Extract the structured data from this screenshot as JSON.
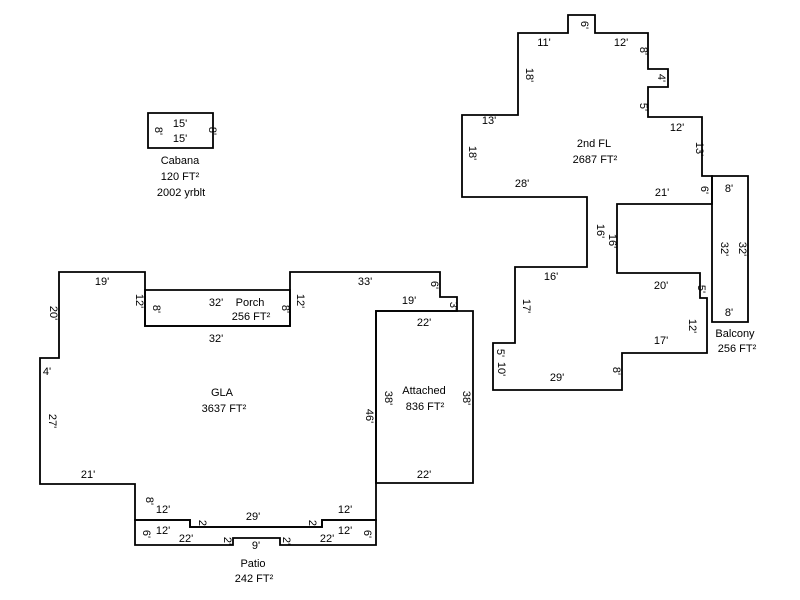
{
  "sketch": {
    "canvas": {
      "width": 800,
      "height": 600,
      "background": "#ffffff",
      "line_color": "#000000",
      "text_color": "#000000"
    },
    "areas_summary": [
      {
        "name": "GLA",
        "area": "3637 FT²"
      },
      {
        "name": "2nd FL",
        "area": "2687 FT²"
      },
      {
        "name": "Porch",
        "area": "256 FT²"
      },
      {
        "name": "Attached",
        "area": "836 FT²"
      },
      {
        "name": "Balcony",
        "area": "256 FT²"
      },
      {
        "name": "Patio",
        "area": "242 FT²"
      },
      {
        "name": "Cabana",
        "area": "120 FT²",
        "note": "2002 yrblt"
      }
    ],
    "outlines": [
      {
        "name": "cabana-outline",
        "points": "148,113 213,113 213,148 148,148"
      },
      {
        "name": "second-floor-outline",
        "points": "518,33 568,33 568,15 595,15 595,33 648,33 648,69 668,69 668,87 648,87 648,117 702,117 702,176 712,176 712,204 617,204 617,273 700,273 700,298 707,298 707,353 622,353 622,390 493,390 493,343 515,343 515,267 587,267 587,197 462,197 462,115 518,115"
      },
      {
        "name": "balcony-outline",
        "points": "712,176 748,176 748,322 712,322"
      },
      {
        "name": "gla-outline",
        "points": "59,272 145,272 145,326 290,326 290,272 440,272 440,297 457,297 457,311 376,311 376,520 322,520 322,527 190,527 190,520 135,520 135,484 40,484 40,358 59,358"
      },
      {
        "name": "porch-outline",
        "points": "145,290 290,290 290,326 145,326"
      },
      {
        "name": "attached-outline",
        "points": "376,311 473,311 473,483 376,483"
      },
      {
        "name": "patio-outline",
        "points": "135,520 190,520 190,527 322,527 322,520 376,520 376,545 280,545 280,538 233,538 233,545 135,545"
      }
    ],
    "labels": [
      {
        "name": "dim-label",
        "text": "15'",
        "x": 180,
        "y": 127,
        "rot": 0
      },
      {
        "name": "dim-label",
        "text": "8'",
        "x": 155,
        "y": 131,
        "rot": 1
      },
      {
        "name": "dim-label",
        "text": "8'",
        "x": 209,
        "y": 131,
        "rot": 1
      },
      {
        "name": "dim-label",
        "text": "15'",
        "x": 180,
        "y": 142,
        "rot": 0
      },
      {
        "name": "cabana-name-label",
        "text": "Cabana",
        "x": 180,
        "y": 164,
        "rot": 0
      },
      {
        "name": "cabana-area-label",
        "text": "120 FT²",
        "x": 180,
        "y": 180,
        "rot": 0
      },
      {
        "name": "cabana-yrblt-label",
        "text": "2002 yrblt",
        "x": 181,
        "y": 196,
        "rot": 0
      },
      {
        "name": "dim-label",
        "text": "11'",
        "x": 544,
        "y": 46,
        "rot": 0
      },
      {
        "name": "dim-label",
        "text": "6'",
        "x": 581,
        "y": 25,
        "rot": 1
      },
      {
        "name": "dim-label",
        "text": "12'",
        "x": 621,
        "y": 46,
        "rot": 0
      },
      {
        "name": "dim-label",
        "text": "8'",
        "x": 640,
        "y": 51,
        "rot": 1
      },
      {
        "name": "dim-label",
        "text": "4'",
        "x": 658,
        "y": 78,
        "rot": 1
      },
      {
        "name": "dim-label",
        "text": "5'",
        "x": 640,
        "y": 107,
        "rot": 1
      },
      {
        "name": "dim-label",
        "text": "12'",
        "x": 677,
        "y": 131,
        "rot": 0
      },
      {
        "name": "dim-label",
        "text": "13'",
        "x": 696,
        "y": 149,
        "rot": 1
      },
      {
        "name": "dim-label",
        "text": "13'",
        "x": 489,
        "y": 124,
        "rot": 0
      },
      {
        "name": "dim-label",
        "text": "18'",
        "x": 469,
        "y": 153,
        "rot": 1
      },
      {
        "name": "dim-label",
        "text": "18'",
        "x": 526,
        "y": 75,
        "rot": 1
      },
      {
        "name": "secondfl-name-label",
        "text": "2nd FL",
        "x": 594,
        "y": 147,
        "rot": 0
      },
      {
        "name": "secondfl-area-label",
        "text": "2687 FT²",
        "x": 595,
        "y": 163,
        "rot": 0
      },
      {
        "name": "dim-label",
        "text": "28'",
        "x": 522,
        "y": 187,
        "rot": 0
      },
      {
        "name": "dim-label",
        "text": "16'",
        "x": 597,
        "y": 231,
        "rot": 1
      },
      {
        "name": "dim-label",
        "text": "16'",
        "x": 609,
        "y": 241,
        "rot": 1
      },
      {
        "name": "dim-label",
        "text": "21'",
        "x": 662,
        "y": 196,
        "rot": 0
      },
      {
        "name": "dim-label",
        "text": "6'",
        "x": 701,
        "y": 190,
        "rot": 1
      },
      {
        "name": "dim-label",
        "text": "16'",
        "x": 551,
        "y": 280,
        "rot": 0
      },
      {
        "name": "dim-label",
        "text": "17'",
        "x": 523,
        "y": 306,
        "rot": 1
      },
      {
        "name": "dim-label",
        "text": "20'",
        "x": 661,
        "y": 289,
        "rot": 0
      },
      {
        "name": "dim-label",
        "text": "5'",
        "x": 698,
        "y": 289,
        "rot": 1
      },
      {
        "name": "dim-label",
        "text": "12'",
        "x": 689,
        "y": 326,
        "rot": 1
      },
      {
        "name": "dim-label",
        "text": "17'",
        "x": 661,
        "y": 344,
        "rot": 0
      },
      {
        "name": "dim-label",
        "text": "5'",
        "x": 497,
        "y": 353,
        "rot": 1
      },
      {
        "name": "dim-label",
        "text": "10'",
        "x": 498,
        "y": 369,
        "rot": 1
      },
      {
        "name": "dim-label",
        "text": "29'",
        "x": 557,
        "y": 381,
        "rot": 0
      },
      {
        "name": "dim-label",
        "text": "8'",
        "x": 613,
        "y": 371,
        "rot": 1
      },
      {
        "name": "dim-label",
        "text": "8'",
        "x": 729,
        "y": 192,
        "rot": 0
      },
      {
        "name": "dim-label",
        "text": "32'",
        "x": 721,
        "y": 249,
        "rot": 1
      },
      {
        "name": "dim-label",
        "text": "32'",
        "x": 739,
        "y": 249,
        "rot": 1
      },
      {
        "name": "dim-label",
        "text": "8'",
        "x": 729,
        "y": 316,
        "rot": 0
      },
      {
        "name": "balcony-name-label",
        "text": "Balcony",
        "x": 735,
        "y": 337,
        "rot": 0
      },
      {
        "name": "balcony-area-label",
        "text": "256 FT²",
        "x": 737,
        "y": 352,
        "rot": 0
      },
      {
        "name": "dim-label",
        "text": "19'",
        "x": 102,
        "y": 285,
        "rot": 0
      },
      {
        "name": "dim-label",
        "text": "12'",
        "x": 136,
        "y": 301,
        "rot": 1
      },
      {
        "name": "dim-label",
        "text": "12'",
        "x": 297,
        "y": 301,
        "rot": 1
      },
      {
        "name": "dim-label",
        "text": "33'",
        "x": 365,
        "y": 285,
        "rot": 0
      },
      {
        "name": "dim-label",
        "text": "6'",
        "x": 431,
        "y": 285,
        "rot": 1
      },
      {
        "name": "dim-label",
        "text": "19'",
        "x": 409,
        "y": 304,
        "rot": 0
      },
      {
        "name": "dim-label",
        "text": "3'",
        "x": 450,
        "y": 306,
        "rot": 1
      },
      {
        "name": "dim-label",
        "text": "20'",
        "x": 50,
        "y": 313,
        "rot": 1
      },
      {
        "name": "dim-label",
        "text": "4'",
        "x": 47,
        "y": 375,
        "rot": 0
      },
      {
        "name": "dim-label",
        "text": "27'",
        "x": 49,
        "y": 421,
        "rot": 1
      },
      {
        "name": "dim-label",
        "text": "21'",
        "x": 88,
        "y": 478,
        "rot": 0
      },
      {
        "name": "dim-label",
        "text": "8'",
        "x": 146,
        "y": 501,
        "rot": 1
      },
      {
        "name": "dim-label",
        "text": "12'",
        "x": 163,
        "y": 513,
        "rot": 0
      },
      {
        "name": "dim-label",
        "text": "2'",
        "x": 199,
        "y": 524,
        "rot": 1
      },
      {
        "name": "dim-label",
        "text": "29'",
        "x": 253,
        "y": 520,
        "rot": 0
      },
      {
        "name": "dim-label",
        "text": "2'",
        "x": 309,
        "y": 524,
        "rot": 1
      },
      {
        "name": "dim-label",
        "text": "12'",
        "x": 345,
        "y": 513,
        "rot": 0
      },
      {
        "name": "dim-label",
        "text": "46'",
        "x": 366,
        "y": 416,
        "rot": 1
      },
      {
        "name": "gla-name-label",
        "text": "GLA",
        "x": 222,
        "y": 396,
        "rot": 0
      },
      {
        "name": "gla-area-label",
        "text": "3637 FT²",
        "x": 224,
        "y": 412,
        "rot": 0
      },
      {
        "name": "dim-label",
        "text": "32'",
        "x": 216,
        "y": 306,
        "rot": 0
      },
      {
        "name": "porch-name-label",
        "text": "Porch",
        "x": 250,
        "y": 306,
        "rot": 0
      },
      {
        "name": "porch-area-label",
        "text": "256 FT²",
        "x": 251,
        "y": 320,
        "rot": 0
      },
      {
        "name": "dim-label",
        "text": "8'",
        "x": 153,
        "y": 309,
        "rot": 1
      },
      {
        "name": "dim-label",
        "text": "8'",
        "x": 282,
        "y": 309,
        "rot": 1
      },
      {
        "name": "dim-label",
        "text": "32'",
        "x": 216,
        "y": 342,
        "rot": 0
      },
      {
        "name": "dim-label",
        "text": "22'",
        "x": 424,
        "y": 326,
        "rot": 0
      },
      {
        "name": "dim-label",
        "text": "38'",
        "x": 385,
        "y": 398,
        "rot": 1
      },
      {
        "name": "attached-name-label",
        "text": "Attached",
        "x": 424,
        "y": 394,
        "rot": 0
      },
      {
        "name": "attached-area-label",
        "text": "836 FT²",
        "x": 425,
        "y": 410,
        "rot": 0
      },
      {
        "name": "dim-label",
        "text": "38'",
        "x": 463,
        "y": 398,
        "rot": 1
      },
      {
        "name": "dim-label",
        "text": "22'",
        "x": 424,
        "y": 478,
        "rot": 0
      },
      {
        "name": "dim-label",
        "text": "6'",
        "x": 143,
        "y": 534,
        "rot": 1
      },
      {
        "name": "dim-label",
        "text": "12'",
        "x": 163,
        "y": 534,
        "rot": 0
      },
      {
        "name": "dim-label",
        "text": "22'",
        "x": 186,
        "y": 542,
        "rot": 0
      },
      {
        "name": "dim-label",
        "text": "2'",
        "x": 224,
        "y": 541,
        "rot": 1
      },
      {
        "name": "dim-label",
        "text": "9'",
        "x": 256,
        "y": 549,
        "rot": 0
      },
      {
        "name": "dim-label",
        "text": "2'",
        "x": 283,
        "y": 541,
        "rot": 1
      },
      {
        "name": "dim-label",
        "text": "22'",
        "x": 327,
        "y": 542,
        "rot": 0
      },
      {
        "name": "dim-label",
        "text": "12'",
        "x": 345,
        "y": 534,
        "rot": 0
      },
      {
        "name": "dim-label",
        "text": "6'",
        "x": 364,
        "y": 534,
        "rot": 1
      },
      {
        "name": "patio-name-label",
        "text": "Patio",
        "x": 253,
        "y": 567,
        "rot": 0
      },
      {
        "name": "patio-area-label",
        "text": "242 FT²",
        "x": 254,
        "y": 582,
        "rot": 0
      }
    ]
  }
}
